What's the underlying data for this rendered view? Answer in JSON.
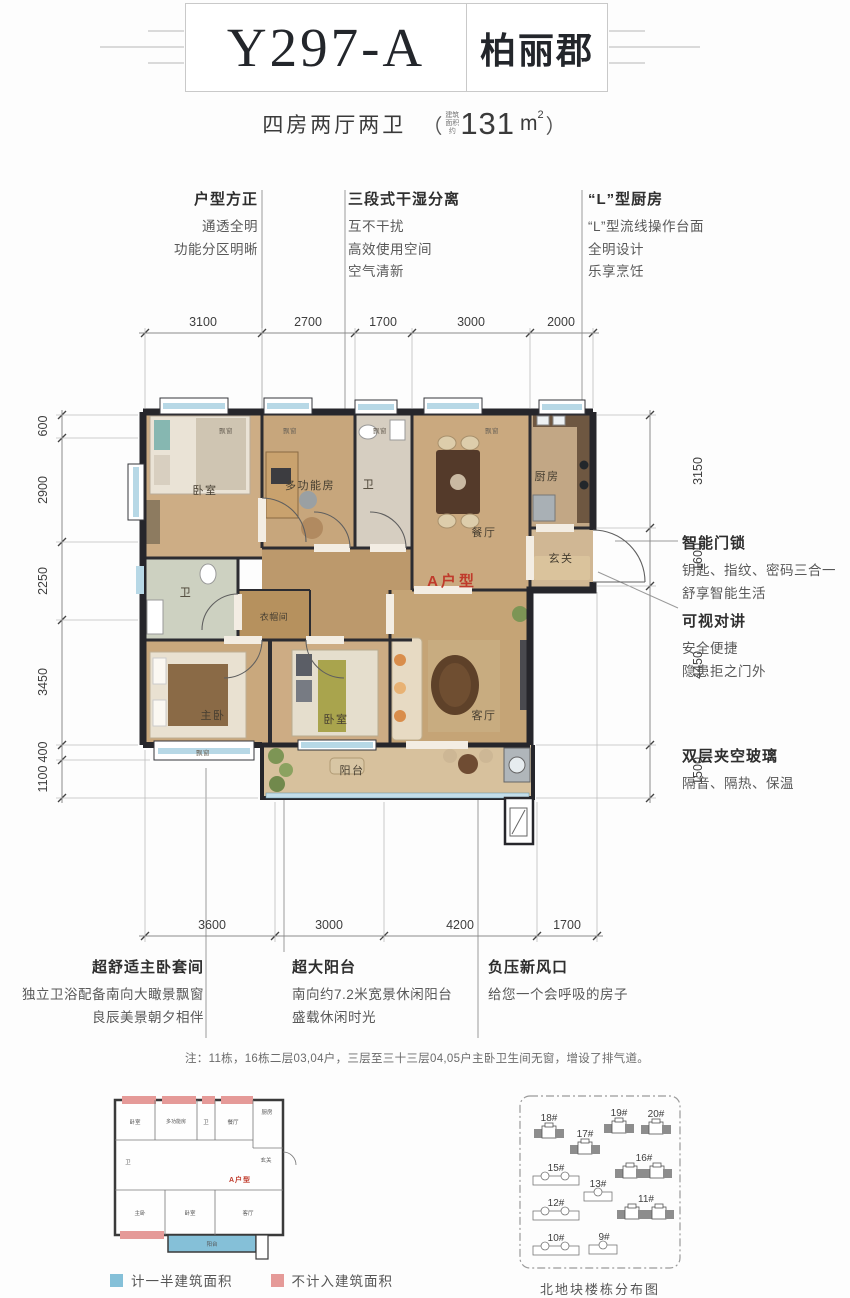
{
  "header": {
    "model": "Y297-A",
    "project": "柏丽郡"
  },
  "subtitle": {
    "layout": "四房两厅两卫",
    "paren_open": "（",
    "area_prefix_lines": [
      "建筑",
      "面积",
      "约"
    ],
    "area_value": "131",
    "area_unit": "m",
    "area_exponent": "2",
    "paren_close": "）"
  },
  "features_top": [
    {
      "title": "户型方正",
      "lines": [
        "通透全明",
        "功能分区明晰"
      ]
    },
    {
      "title": "三段式干湿分离",
      "lines": [
        "互不干扰",
        "高效使用空间",
        "空气清新"
      ]
    },
    {
      "title": "“L”型厨房",
      "lines": [
        "“L”型流线操作台面",
        "全明设计",
        "乐享烹饪"
      ]
    }
  ],
  "features_right": [
    {
      "title": "智能门锁",
      "lines": [
        "钥匙、指纹、密码三合一",
        "舒享智能生活"
      ]
    },
    {
      "title": "可视对讲",
      "lines": [
        "安全便捷",
        "隐患拒之门外"
      ]
    },
    {
      "title": "双层夹空玻璃",
      "lines": [
        "隔音、隔热、保温"
      ]
    }
  ],
  "features_bottom": [
    {
      "title": "超舒适主卧套间",
      "lines": [
        "独立卫浴配备南向大瞰景飘窗",
        "良辰美景朝夕相伴"
      ]
    },
    {
      "title": "超大阳台",
      "lines": [
        "南向约7.2米宽景休闲阳台",
        "盛载休闲时光"
      ]
    },
    {
      "title": "负压新风口",
      "lines": [
        "给您一个会呼吸的房子"
      ]
    }
  ],
  "dimensions": {
    "top": [
      "3100",
      "2700",
      "1700",
      "3000",
      "2000"
    ],
    "bottom": [
      "3600",
      "3000",
      "4200",
      "1700"
    ],
    "left": [
      "600",
      "2900",
      "2250",
      "3450",
      "400",
      "1100"
    ],
    "right": [
      "3150",
      "1600",
      "4450",
      "1500"
    ]
  },
  "rooms": {
    "bedroom_top": "卧室",
    "multi_room": "多功能房",
    "bath_top": "卫",
    "dining": "餐厅",
    "kitchen": "厨房",
    "foyer": "玄关",
    "bath_master": "卫",
    "closet": "衣帽间",
    "master": "主卧",
    "bedroom2": "卧室",
    "living": "客厅",
    "balcony": "阳台",
    "bay_window": "飘窗",
    "unit_tag": "A户型"
  },
  "note": "注：11栋，16栋二层03,04户，三层至三十三层04,05户主卧卫生间无窗，增设了排气道。",
  "legend": [
    {
      "label": "计一半建筑面积",
      "color": "#85c0d8"
    },
    {
      "label": "不计入建筑面积",
      "color": "#e59a98"
    }
  ],
  "miniplan": {
    "unit_tag": "A户型",
    "labels": {
      "bedroom": "卧室",
      "multi": "多功能房",
      "bath": "卫",
      "dining": "餐厅",
      "kitchen": "厨房",
      "foyer": "玄关",
      "bath2": "卫",
      "master": "主卧",
      "bedroom2": "卧室",
      "living": "客厅",
      "balcony": "阳台"
    }
  },
  "siteplan": {
    "caption": "北地块楼栋分布图",
    "buildings": [
      {
        "label": "18#"
      },
      {
        "label": "17#"
      },
      {
        "label": "19#"
      },
      {
        "label": "20#"
      },
      {
        "label": "15#"
      },
      {
        "label": "16#"
      },
      {
        "label": "13#"
      },
      {
        "label": "12#"
      },
      {
        "label": "11#"
      },
      {
        "label": "10#"
      },
      {
        "label": "9#"
      }
    ]
  },
  "colors": {
    "accent_red": "#c03a2b",
    "wall": "#26262b",
    "legend_half": "#85c0d8",
    "legend_excluded": "#e59a98"
  }
}
